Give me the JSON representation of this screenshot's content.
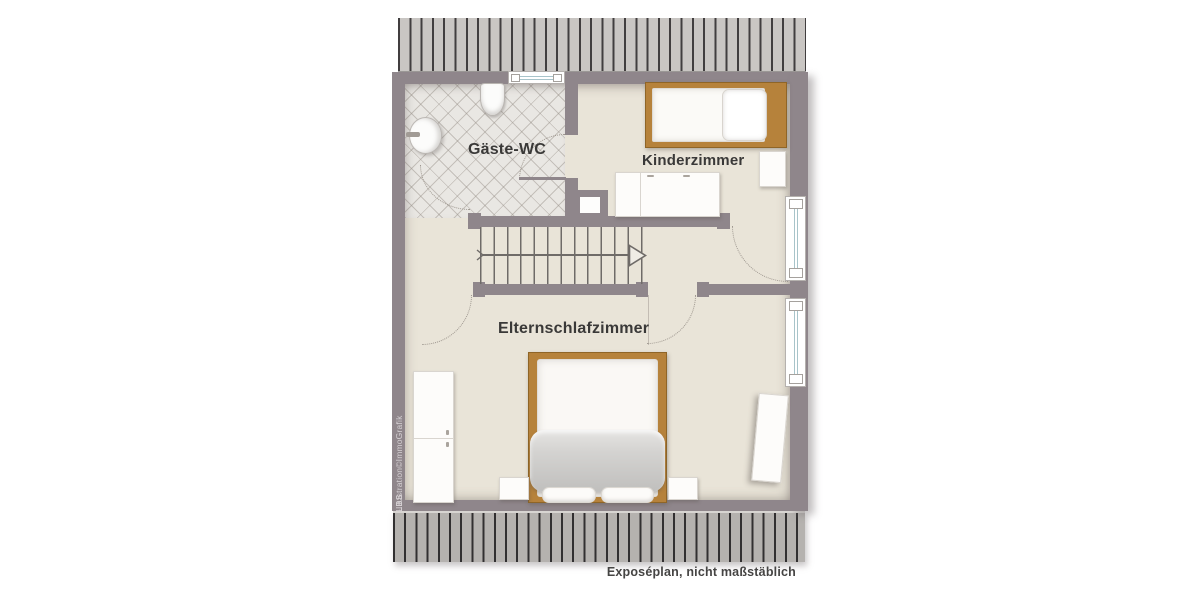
{
  "plan": {
    "labels": {
      "wc": "Gäste-WC",
      "kids": "Kinderzimmer",
      "parents": "Elternschlafzimmer"
    },
    "footnote": "Exposéplan, nicht maßstäblich",
    "credit_bold": "LBS",
    "credit_rest": "-Illustration©ImmoGrafik",
    "colors": {
      "wall": "#8f868b",
      "floor": "#e9e4d8",
      "wc_tile": "#e9e7e3",
      "wood_furniture": "#b6823b",
      "roof_hatch_light": "#c9c6c3",
      "roof_hatch_dark": "#323031",
      "window_glass_line": "#a8c4ca",
      "label_text": "#3a3938"
    }
  }
}
